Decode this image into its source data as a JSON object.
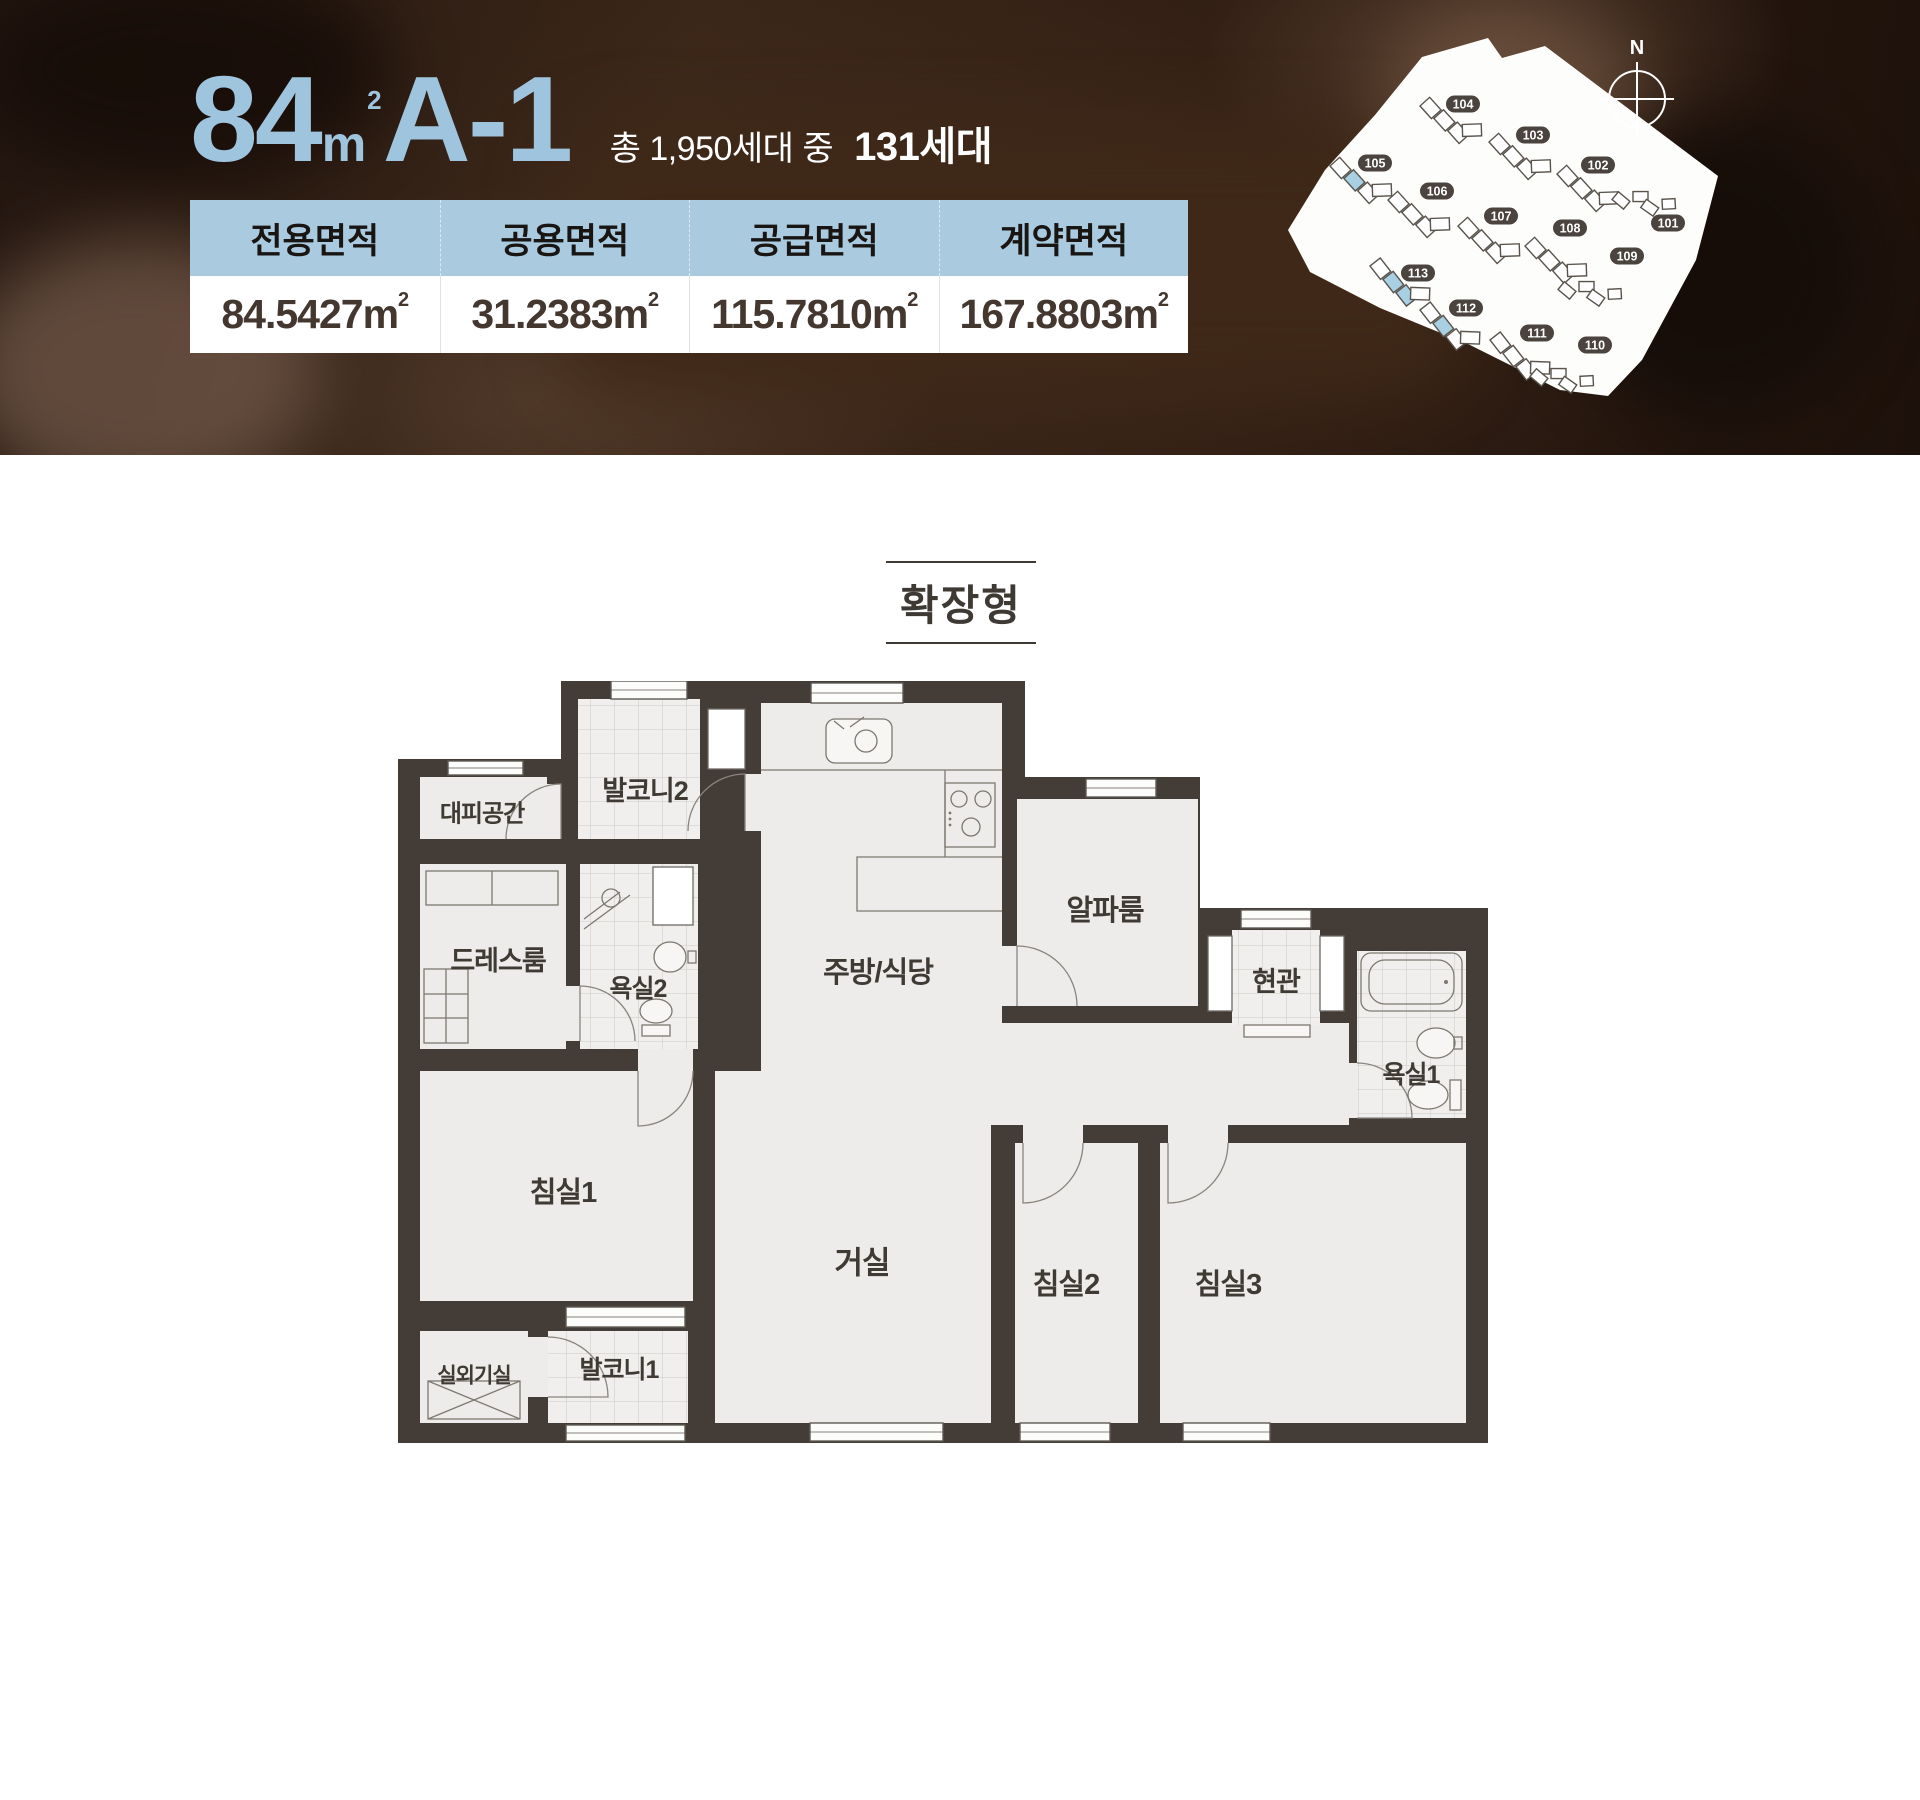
{
  "colors": {
    "accent_blue": "#9fc4dd",
    "table_header": "#a9cadf",
    "wall": "#433c37",
    "unit_highlight": "#a9cfe3",
    "badge": "#4a433e",
    "body_text": "#443730"
  },
  "hero": {
    "title": {
      "area": "84",
      "unit_m": "m",
      "unit_sup": "2",
      "type": "A-1"
    },
    "supply": {
      "prefix": "총 1,950세대 중",
      "highlight": "131세대"
    },
    "table": {
      "unit_m": "m",
      "unit_sup": "2",
      "columns": [
        {
          "label": "전용면적",
          "value": "84.5427"
        },
        {
          "label": "공용면적",
          "value": "31.2383"
        },
        {
          "label": "공급면적",
          "value": "115.7810"
        },
        {
          "label": "계약면적",
          "value": "167.8803"
        }
      ]
    },
    "sitemap": {
      "north": "N",
      "buildings": [
        {
          "id": "101"
        },
        {
          "id": "102"
        },
        {
          "id": "103"
        },
        {
          "id": "104"
        },
        {
          "id": "105"
        },
        {
          "id": "106"
        },
        {
          "id": "107"
        },
        {
          "id": "108"
        },
        {
          "id": "109"
        },
        {
          "id": "110"
        },
        {
          "id": "111"
        },
        {
          "id": "112"
        },
        {
          "id": "113"
        }
      ],
      "highlighted_units": [
        "105",
        "112",
        "113"
      ]
    }
  },
  "plan": {
    "variant_tag": "확장형",
    "rooms": [
      {
        "name": "대피공간"
      },
      {
        "name": "발코니2"
      },
      {
        "name": "드레스룸"
      },
      {
        "name": "욕실2"
      },
      {
        "name": "주방/식당"
      },
      {
        "name": "알파룸"
      },
      {
        "name": "현관"
      },
      {
        "name": "욕실1"
      },
      {
        "name": "침실1"
      },
      {
        "name": "거실"
      },
      {
        "name": "침실2"
      },
      {
        "name": "침실3"
      },
      {
        "name": "실외기실"
      },
      {
        "name": "발코니1"
      }
    ]
  }
}
